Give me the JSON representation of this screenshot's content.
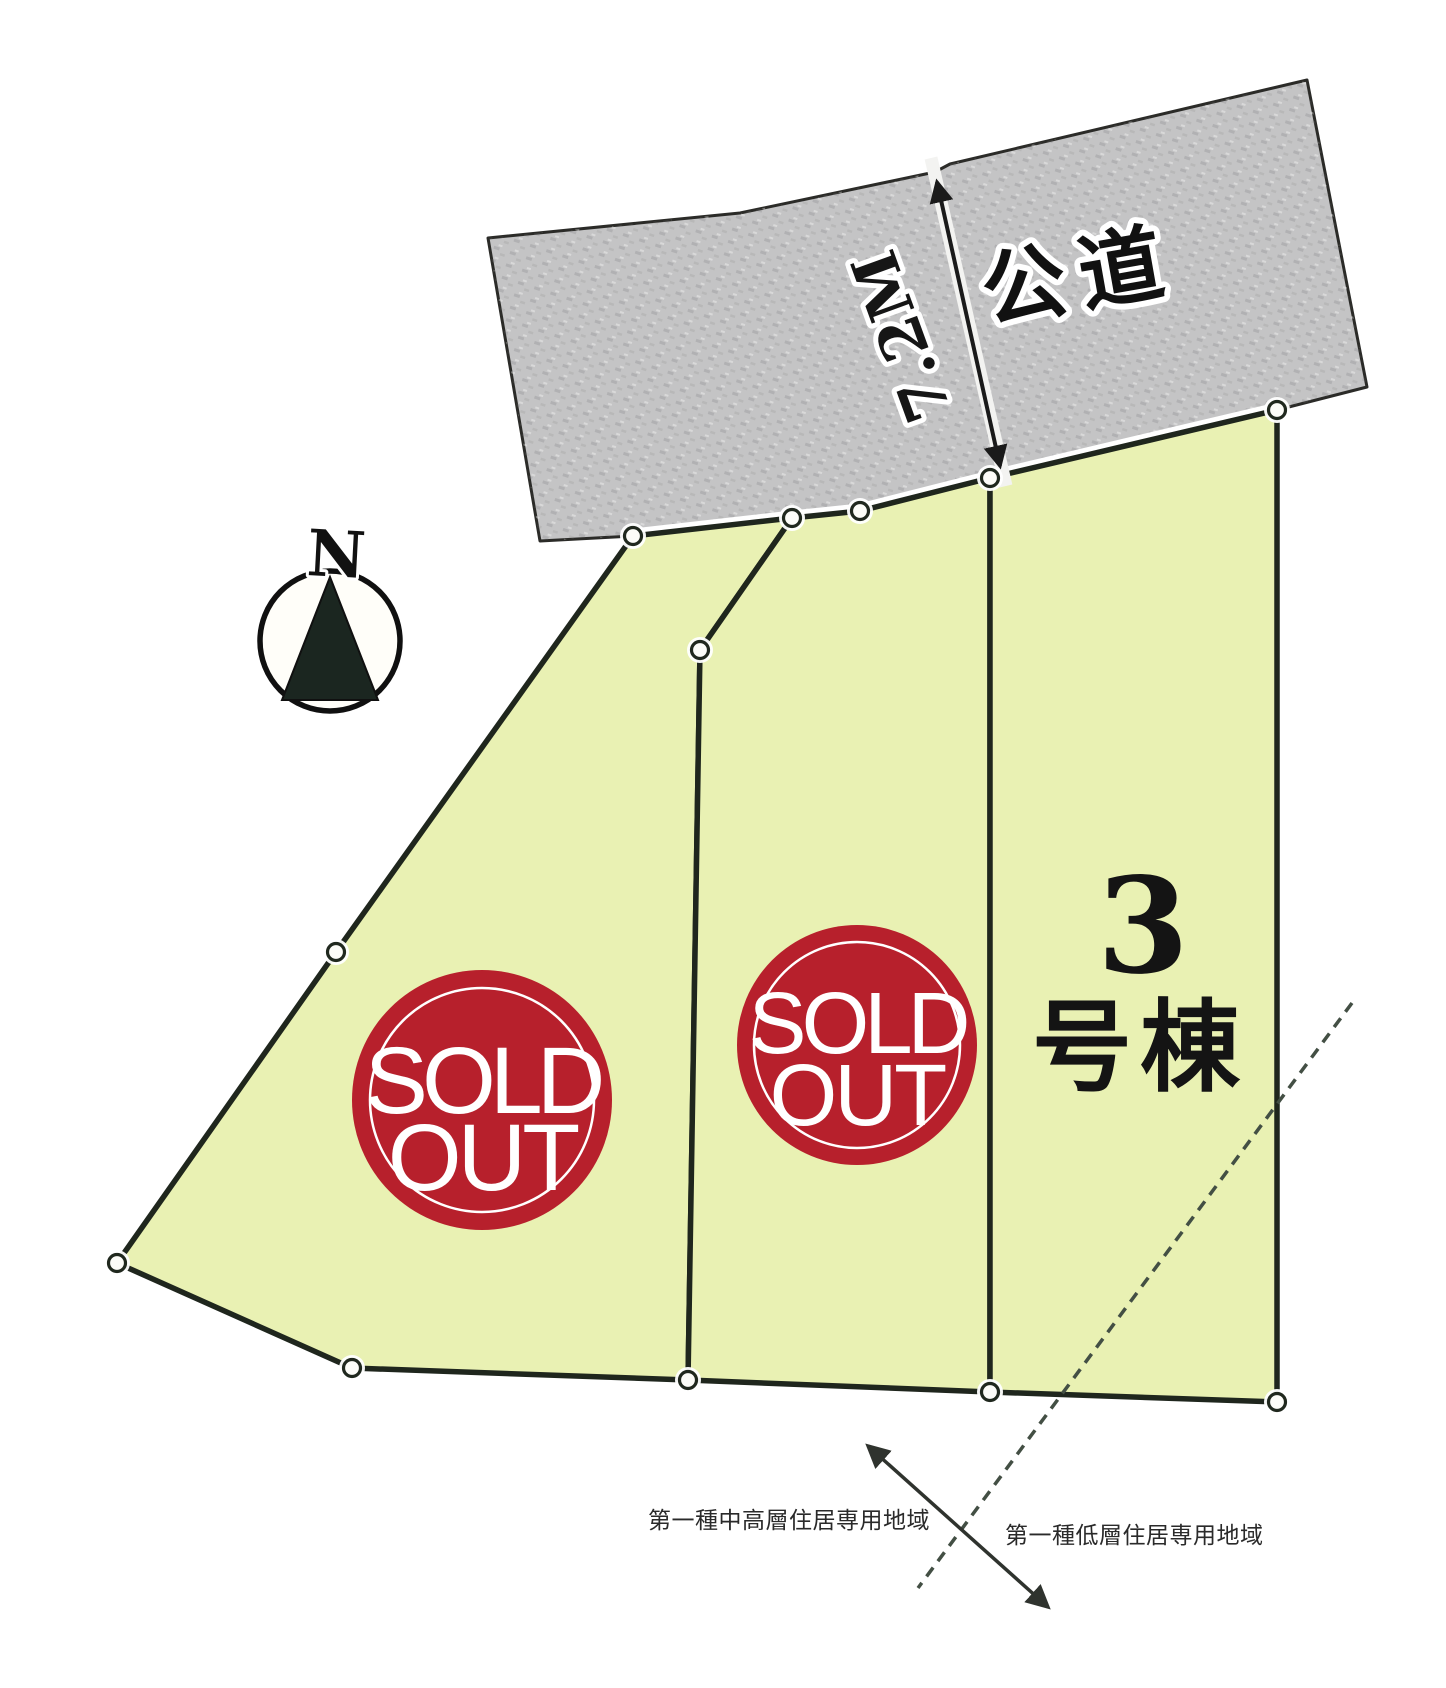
{
  "diagram": {
    "road": {
      "label": "公道",
      "width_label": "7.2M"
    },
    "compass": {
      "north": "N"
    },
    "lots": {
      "lot1": {
        "stamp": {
          "line1": "SOLD",
          "line2": "OUT"
        }
      },
      "lot2": {
        "stamp": {
          "line1": "SOLD",
          "line2": "OUT"
        }
      },
      "lot3": {
        "number": "3",
        "suffix": "号棟"
      }
    },
    "zoning": {
      "left": "第一種中高層住居専用地域",
      "right": "第一種低層住居専用地域"
    },
    "colors": {
      "sold_red": "#b7202c",
      "lot_green": "#e9f1b3",
      "road_gray": "#c4c4c5",
      "outline_dark": "#1f261d",
      "paper": "#ffffff"
    }
  }
}
